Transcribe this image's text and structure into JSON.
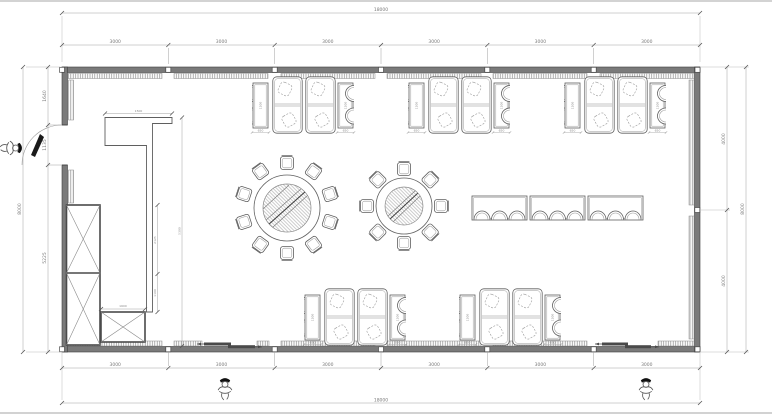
{
  "meta": {
    "drawing_type": "restaurant dining hall floor plan",
    "units": "mm"
  },
  "colors": {
    "wall_fill": "#7a7a7a",
    "wall_stroke": "#3f3f3f",
    "furniture_stroke": "#5f5f5f",
    "light_stroke": "#9a9a9a",
    "dim_line": "#a0a0a0",
    "dim_text": "#7a7a7a",
    "door_leaf": "#1a1a1a"
  },
  "dims": {
    "total_width_top": "18000",
    "bay_top": [
      "3000",
      "3000",
      "3000",
      "3000",
      "3000",
      "3000"
    ],
    "bay_bottom": [
      "3000",
      "3000",
      "3000",
      "3000",
      "3000",
      "3000"
    ],
    "total_width_bottom": "18000",
    "left_total": "8000",
    "left_segs": [
      "1640",
      "1135",
      "5225"
    ],
    "right_segs": [
      "4000",
      "4000"
    ],
    "right_total": "8000",
    "partition_len": "1500",
    "partition_drop": "5300",
    "cabinet_upper": "2125",
    "cabinet_lower": "1100",
    "low_cabinet_w": "1600",
    "table_len": "1200",
    "table_w": "650"
  },
  "furniture": {
    "booth_groups_top": 3,
    "booth_groups_bottom": 2,
    "booth_group_composition": "two 2-seat tables with round-back chairs flanking two 4-seat booth sofas",
    "round_table_large_seats": 10,
    "round_table_small_seats": 8,
    "banquet_tables": 3,
    "banquet_seats": 18,
    "tall_cabinet_sections": 2,
    "low_cabinets": 1,
    "entry_doors": 3,
    "person_symbols": 3
  }
}
